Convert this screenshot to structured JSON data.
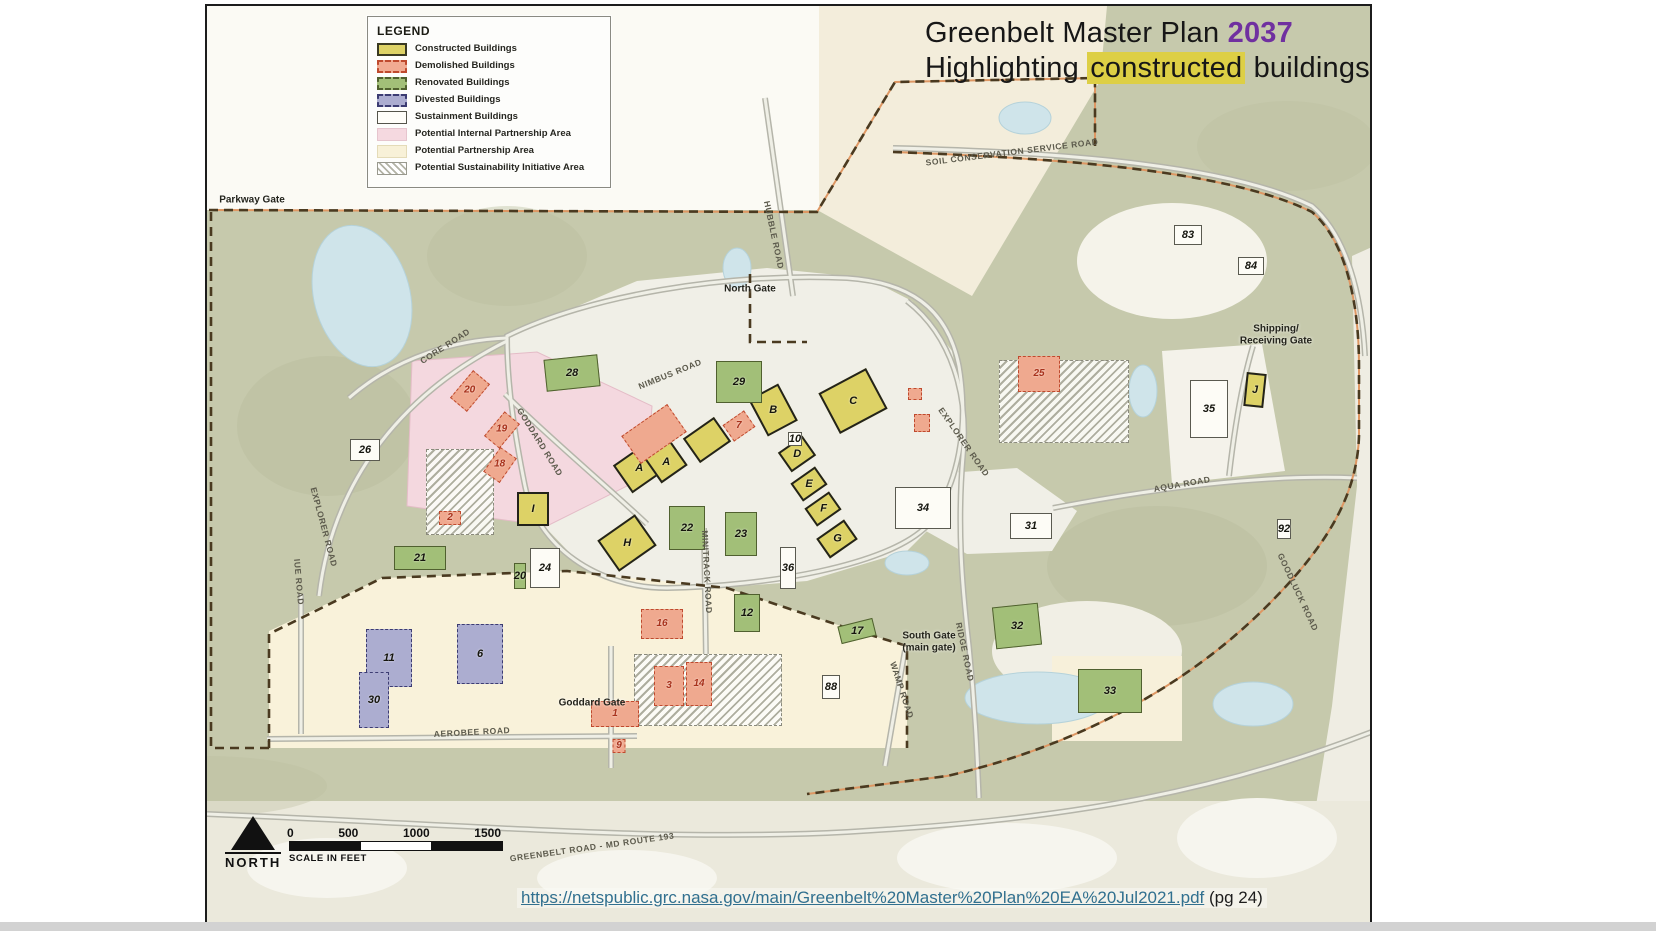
{
  "title": {
    "line1_prefix": "Greenbelt Master Plan ",
    "line1_year": "2037",
    "line2_prefix": "Highlighting ",
    "line2_highlight": "constructed",
    "line2_suffix": " buildings"
  },
  "colors": {
    "year_accent": "#7030a0",
    "highlight_bg": "#ddcf45",
    "link": "#31708f",
    "map_background": "#c6c9ac",
    "constructed": "#ddd266",
    "demolished": "#efa98f",
    "renovated": "#a2bf78",
    "divested": "#acadd0",
    "sustainment": "#fdfcf6",
    "internal_partnership": "#f5d9e0",
    "partnership": "#f8f1d8"
  },
  "legend": {
    "title": "LEGEND",
    "items": [
      {
        "label": "Constructed Buildings",
        "swatch": "sw-constructed"
      },
      {
        "label": "Demolished Buildings",
        "swatch": "sw-demolished"
      },
      {
        "label": "Renovated Buildings",
        "swatch": "sw-renovated"
      },
      {
        "label": "Divested Buildings",
        "swatch": "sw-divested"
      },
      {
        "label": "Sustainment Buildings",
        "swatch": "sw-sustainment"
      },
      {
        "label": "Potential Internal Partnership Area",
        "swatch": "sw-pink"
      },
      {
        "label": "Potential Partnership Area",
        "swatch": "sw-cream"
      },
      {
        "label": "Potential Sustainability Initiative Area",
        "swatch": "sw-hatch"
      }
    ]
  },
  "scale_bar": {
    "ticks": [
      "0",
      "500",
      "1000",
      "1500"
    ],
    "caption": "SCALE IN FEET",
    "north_label": "NORTH"
  },
  "source": {
    "url": "https://netspublic.grc.nasa.gov/main/Greenbelt%20Master%20Plan%20EA%20Jul2021.pdf",
    "link_text": "https://netspublic.grc.nasa.gov/main/Greenbelt%20Master%20Plan%20EA%20Jul2021.pdf",
    "page_note": " (pg 24)"
  },
  "map": {
    "gates": [
      {
        "text": "Parkway Gate",
        "x": 45,
        "y": 194
      },
      {
        "text": "North Gate",
        "x": 543,
        "y": 283
      },
      {
        "text": "Shipping/\nReceiving Gate",
        "x": 1069,
        "y": 329
      },
      {
        "text": "South Gate\n(main gate)",
        "x": 722,
        "y": 636
      },
      {
        "text": "Goddard Gate",
        "x": 385,
        "y": 697
      }
    ],
    "road_labels": [
      {
        "text": "CORE ROAD",
        "x": 238,
        "y": 340,
        "rot": -33
      },
      {
        "text": "GODDARD ROAD",
        "x": 333,
        "y": 436,
        "rot": 58
      },
      {
        "text": "NIMBUS ROAD",
        "x": 463,
        "y": 368,
        "rot": -22
      },
      {
        "text": "HUBBLE ROAD",
        "x": 567,
        "y": 229,
        "rot": 78
      },
      {
        "text": "SOIL CONSERVATION SERVICE ROAD",
        "x": 805,
        "y": 146,
        "rot": -7
      },
      {
        "text": "EXPLORER ROAD",
        "x": 117,
        "y": 521,
        "rot": 75
      },
      {
        "text": "EXPLORER ROAD",
        "x": 757,
        "y": 436,
        "rot": 55
      },
      {
        "text": "AQUA ROAD",
        "x": 975,
        "y": 478,
        "rot": -10
      },
      {
        "text": "GOODLUCK ROAD",
        "x": 1091,
        "y": 586,
        "rot": 65
      },
      {
        "text": "MINITRACK ROAD",
        "x": 500,
        "y": 566,
        "rot": 87
      },
      {
        "text": "AEROBEE ROAD",
        "x": 265,
        "y": 726,
        "rot": -3
      },
      {
        "text": "IUE ROAD",
        "x": 92,
        "y": 576,
        "rot": 85
      },
      {
        "text": "WAMP ROAD",
        "x": 695,
        "y": 684,
        "rot": 72
      },
      {
        "text": "RIDGE ROAD",
        "x": 758,
        "y": 646,
        "rot": 78
      },
      {
        "text": "GREENBELT ROAD - MD ROUTE 193",
        "x": 385,
        "y": 841,
        "rot": -8
      }
    ],
    "hatch_areas": [
      {
        "x": 219,
        "y": 443,
        "w": 68,
        "h": 86
      },
      {
        "x": 427,
        "y": 648,
        "w": 148,
        "h": 72
      },
      {
        "x": 792,
        "y": 354,
        "w": 130,
        "h": 83
      }
    ],
    "buildings": [
      {
        "label": "A",
        "cat": "constructed",
        "x": 432,
        "y": 462,
        "w": 40,
        "h": 34,
        "r": -35
      },
      {
        "label": "A",
        "cat": "constructed",
        "x": 459,
        "y": 456,
        "w": 32,
        "h": 30,
        "r": -35
      },
      {
        "label": "",
        "cat": "constructed",
        "x": 500,
        "y": 434,
        "w": 38,
        "h": 30,
        "r": -35
      },
      {
        "label": "B",
        "cat": "constructed",
        "x": 566,
        "y": 404,
        "w": 34,
        "h": 42,
        "r": -28
      },
      {
        "label": "C",
        "cat": "constructed",
        "x": 646,
        "y": 395,
        "w": 54,
        "h": 46,
        "r": -28
      },
      {
        "label": "D",
        "cat": "constructed",
        "x": 590,
        "y": 448,
        "w": 30,
        "h": 24,
        "r": -35
      },
      {
        "label": "E",
        "cat": "constructed",
        "x": 602,
        "y": 478,
        "w": 30,
        "h": 22,
        "r": -35
      },
      {
        "label": "F",
        "cat": "constructed",
        "x": 616,
        "y": 503,
        "w": 30,
        "h": 22,
        "r": -35
      },
      {
        "label": "G",
        "cat": "constructed",
        "x": 630,
        "y": 533,
        "w": 34,
        "h": 24,
        "r": -35
      },
      {
        "label": "H",
        "cat": "constructed",
        "x": 420,
        "y": 537,
        "w": 46,
        "h": 38,
        "r": -35
      },
      {
        "label": "I",
        "cat": "constructed",
        "x": 326,
        "y": 503,
        "w": 32,
        "h": 34,
        "r": 0
      },
      {
        "label": "J",
        "cat": "constructed",
        "x": 1048,
        "y": 384,
        "w": 20,
        "h": 34,
        "r": 6
      },
      {
        "label": "28",
        "cat": "renovated",
        "x": 365,
        "y": 367,
        "w": 54,
        "h": 32,
        "r": -6
      },
      {
        "label": "29",
        "cat": "renovated",
        "x": 532,
        "y": 376,
        "w": 46,
        "h": 42,
        "r": 0
      },
      {
        "label": "21",
        "cat": "renovated",
        "x": 213,
        "y": 552,
        "w": 52,
        "h": 24,
        "r": 0
      },
      {
        "label": "22",
        "cat": "renovated",
        "x": 480,
        "y": 522,
        "w": 36,
        "h": 44,
        "r": 0
      },
      {
        "label": "23",
        "cat": "renovated",
        "x": 534,
        "y": 528,
        "w": 32,
        "h": 44,
        "r": 0
      },
      {
        "label": "12",
        "cat": "renovated",
        "x": 540,
        "y": 607,
        "w": 26,
        "h": 38,
        "r": 0
      },
      {
        "label": "17",
        "cat": "renovated",
        "x": 650,
        "y": 625,
        "w": 36,
        "h": 18,
        "r": -14
      },
      {
        "label": "32",
        "cat": "renovated",
        "x": 810,
        "y": 620,
        "w": 46,
        "h": 42,
        "r": -6
      },
      {
        "label": "33",
        "cat": "renovated",
        "x": 903,
        "y": 685,
        "w": 64,
        "h": 44,
        "r": 0
      },
      {
        "label": "20",
        "cat": "renovated",
        "x": 313,
        "y": 570,
        "w": 12,
        "h": 26,
        "r": 0
      },
      {
        "label": "26",
        "cat": "sustainment",
        "x": 158,
        "y": 444,
        "w": 30,
        "h": 22,
        "r": 0
      },
      {
        "label": "24",
        "cat": "sustainment",
        "x": 338,
        "y": 562,
        "w": 30,
        "h": 40,
        "r": 0
      },
      {
        "label": "34",
        "cat": "sustainment",
        "x": 716,
        "y": 502,
        "w": 56,
        "h": 42,
        "r": 0
      },
      {
        "label": "31",
        "cat": "sustainment",
        "x": 824,
        "y": 520,
        "w": 42,
        "h": 26,
        "r": 0
      },
      {
        "label": "35",
        "cat": "sustainment",
        "x": 1002,
        "y": 403,
        "w": 38,
        "h": 58,
        "r": 0
      },
      {
        "label": "36",
        "cat": "sustainment",
        "x": 581,
        "y": 562,
        "w": 16,
        "h": 42,
        "r": 0
      },
      {
        "label": "88",
        "cat": "sustainment",
        "x": 624,
        "y": 681,
        "w": 18,
        "h": 24,
        "r": 0
      },
      {
        "label": "92",
        "cat": "sustainment",
        "x": 1077,
        "y": 523,
        "w": 14,
        "h": 20,
        "r": 0
      },
      {
        "label": "83",
        "cat": "sustainment",
        "x": 981,
        "y": 229,
        "w": 28,
        "h": 20,
        "r": 0
      },
      {
        "label": "84",
        "cat": "sustainment",
        "x": 1044,
        "y": 260,
        "w": 26,
        "h": 18,
        "r": 0
      },
      {
        "label": "10",
        "cat": "sustainment",
        "x": 588,
        "y": 433,
        "w": 14,
        "h": 14,
        "r": 0
      },
      {
        "label": "",
        "cat": "demolished",
        "x": 447,
        "y": 428,
        "w": 56,
        "h": 34,
        "r": -35
      },
      {
        "label": "7",
        "cat": "demolished",
        "x": 532,
        "y": 420,
        "w": 26,
        "h": 20,
        "r": -35
      },
      {
        "label": "2",
        "cat": "demolished",
        "x": 243,
        "y": 512,
        "w": 22,
        "h": 14,
        "r": 0
      },
      {
        "label": "20",
        "cat": "demolished",
        "x": 263,
        "y": 385,
        "w": 22,
        "h": 36,
        "r": 40
      },
      {
        "label": "19",
        "cat": "demolished",
        "x": 295,
        "y": 424,
        "w": 20,
        "h": 32,
        "r": 40
      },
      {
        "label": "18",
        "cat": "demolished",
        "x": 293,
        "y": 459,
        "w": 20,
        "h": 30,
        "r": 35
      },
      {
        "label": "16",
        "cat": "demolished",
        "x": 455,
        "y": 618,
        "w": 42,
        "h": 30,
        "r": 0
      },
      {
        "label": "1",
        "cat": "demolished",
        "x": 408,
        "y": 708,
        "w": 48,
        "h": 26,
        "r": 0
      },
      {
        "label": "3",
        "cat": "demolished",
        "x": 462,
        "y": 680,
        "w": 30,
        "h": 40,
        "r": 0
      },
      {
        "label": "14",
        "cat": "demolished",
        "x": 492,
        "y": 678,
        "w": 26,
        "h": 44,
        "r": 0
      },
      {
        "label": "9",
        "cat": "demolished",
        "x": 412,
        "y": 740,
        "w": 13,
        "h": 14,
        "r": 0
      },
      {
        "label": "25",
        "cat": "demolished",
        "x": 832,
        "y": 368,
        "w": 42,
        "h": 36,
        "r": 0
      },
      {
        "label": "",
        "cat": "demolished",
        "x": 708,
        "y": 388,
        "w": 14,
        "h": 12,
        "r": 0
      },
      {
        "label": "",
        "cat": "demolished",
        "x": 715,
        "y": 417,
        "w": 16,
        "h": 18,
        "r": 0
      },
      {
        "label": "11",
        "cat": "divested",
        "x": 182,
        "y": 652,
        "w": 46,
        "h": 58,
        "r": 0
      },
      {
        "label": "6",
        "cat": "divested",
        "x": 273,
        "y": 648,
        "w": 46,
        "h": 60,
        "r": 0
      },
      {
        "label": "30",
        "cat": "divested",
        "x": 167,
        "y": 694,
        "w": 30,
        "h": 56,
        "r": 0
      }
    ]
  }
}
